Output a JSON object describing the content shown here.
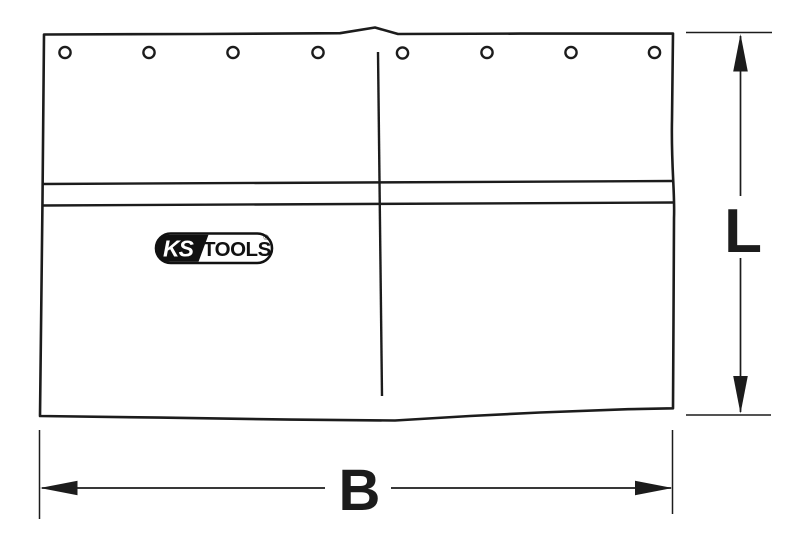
{
  "diagram": {
    "labels": {
      "width": "B",
      "height": "L"
    },
    "logo": {
      "ks": "KS",
      "tools": "TOOLS",
      "reg": "®"
    },
    "eyelets": {
      "count": 8
    },
    "colors": {
      "line": "#1c1c1c",
      "logo_black": "#111111",
      "background": "#ffffff"
    }
  }
}
